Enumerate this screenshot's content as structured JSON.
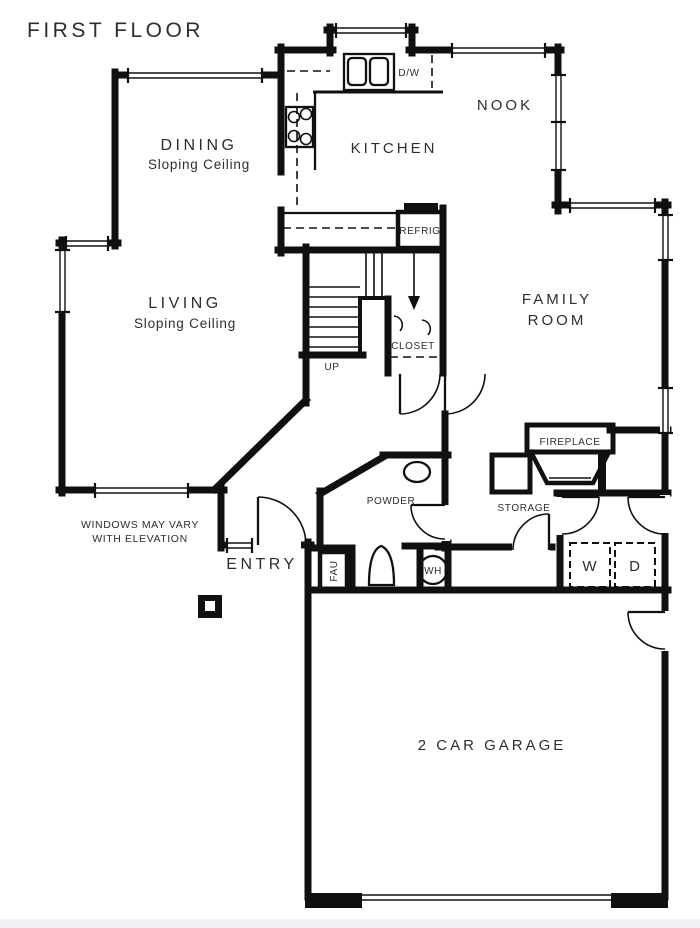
{
  "title": "FIRST FLOOR",
  "note": {
    "line1": "WINDOWS MAY VARY",
    "line2": "WITH ELEVATION"
  },
  "rooms": {
    "dining": {
      "name": "DINING",
      "ceiling": "Sloping Ceiling"
    },
    "kitchen": {
      "name": "KITCHEN"
    },
    "nook": {
      "name": "NOOK"
    },
    "living": {
      "name": "LIVING",
      "ceiling": "Sloping Ceiling"
    },
    "family": {
      "line1": "FAMILY",
      "line2": "ROOM"
    },
    "entry": {
      "name": "ENTRY"
    },
    "powder": {
      "name": "POWDER"
    },
    "closet": {
      "name": "CLOSET"
    },
    "storage": {
      "name": "STORAGE"
    },
    "garage": {
      "name": "2 CAR GARAGE"
    }
  },
  "fixtures": {
    "dishwasher": "D/W",
    "refrigerator": "REFRIG",
    "stairs_direction": "UP",
    "fau": "FAU",
    "water_heater": "WH",
    "washer": "W",
    "dryer": "D",
    "fireplace": "FIREPLACE"
  },
  "colors": {
    "wall": "#101010",
    "text": "#2d2d32",
    "background": "#ffffff"
  }
}
